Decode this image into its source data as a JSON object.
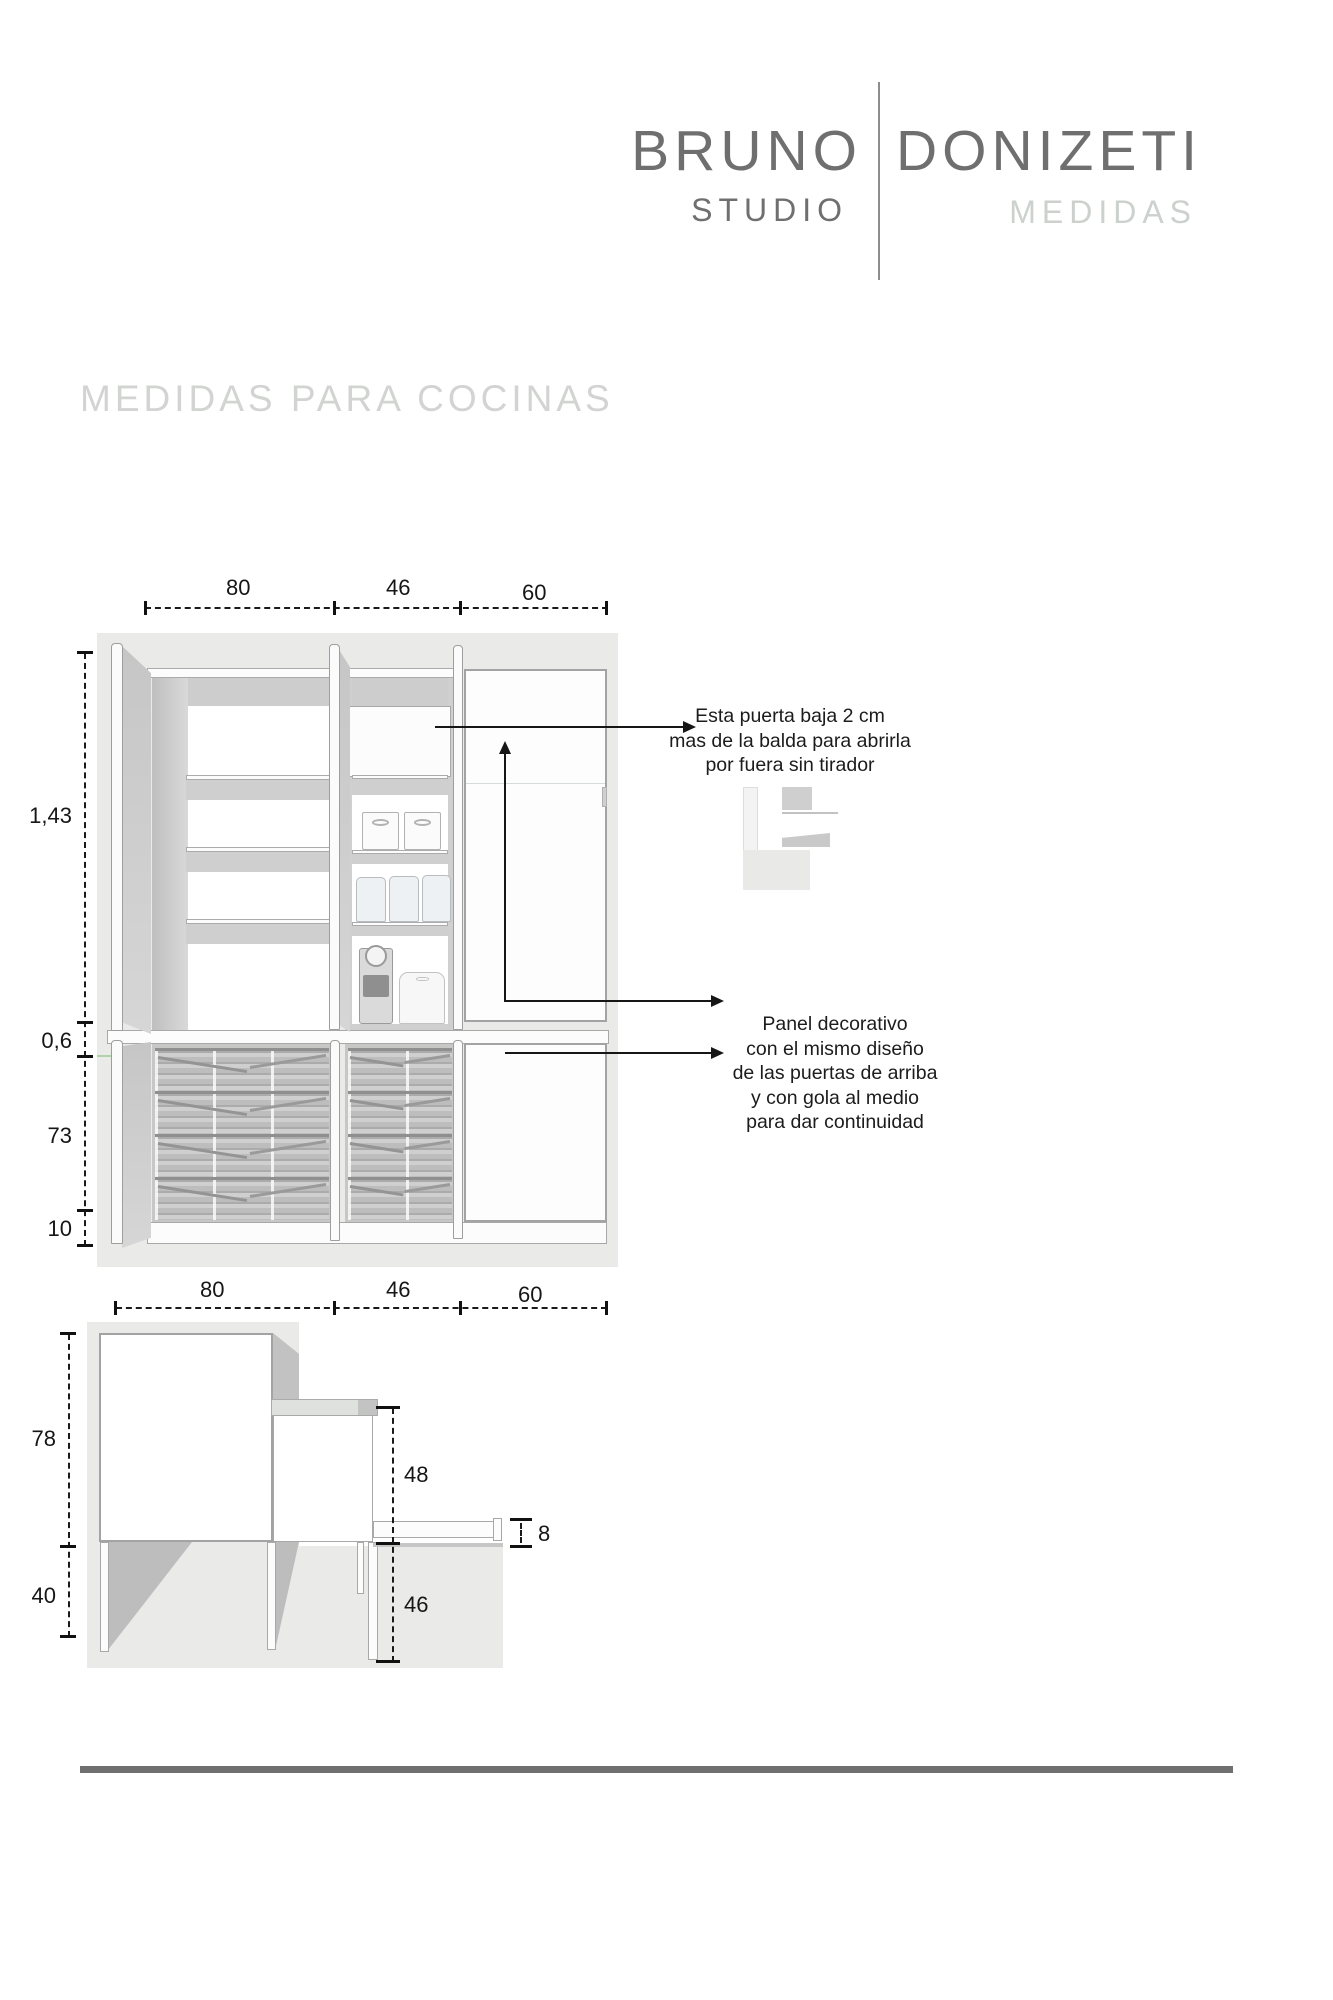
{
  "brand": {
    "first": "BRUNO",
    "second": "DONIZETI",
    "sub": "STUDIO",
    "tag": "MEDIDAS"
  },
  "title": "MEDIDAS PARA COCINAS",
  "front_view": {
    "top_dims": [
      "80",
      "46",
      "60"
    ],
    "left_dims": [
      "1,43",
      "0,6",
      "73",
      "10"
    ]
  },
  "side_view": {
    "top_dims": [
      "80",
      "46",
      "60"
    ],
    "left_dims": [
      "78",
      "40"
    ],
    "inner_dims": [
      "48",
      "46"
    ],
    "thickness_dim": "8"
  },
  "notes": {
    "door_note_lines": [
      "Esta puerta  baja 2 cm",
      "mas de la balda para abrirla",
      "por fuera sin tirador"
    ],
    "panel_note_lines": [
      "Panel decorativo",
      "con el mismo diseño",
      "de las puertas de arriba",
      "y con gola al medio",
      "para dar continuidad"
    ]
  },
  "colors": {
    "logo_gray": "#6f6f6f",
    "muted_gray": "#ccd1cd",
    "drawing_bg": "#eaebe9",
    "line_black": "#1a1a1a",
    "footer_bar": "#707070"
  }
}
